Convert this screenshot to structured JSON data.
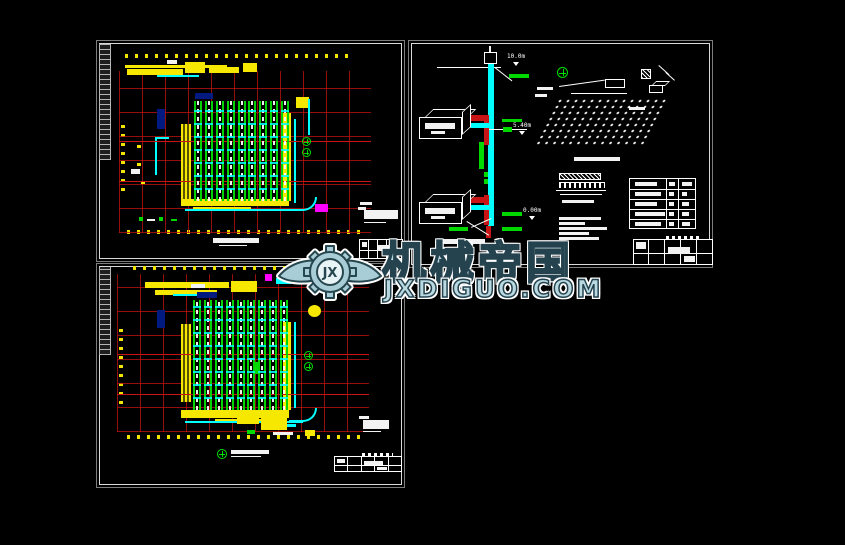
{
  "watermark": {
    "brand_cn": "机械帝国",
    "brand_en": "JXDIGUO.COM",
    "logo_monogram": "JX"
  },
  "schematic": {
    "elevation_labels": {
      "top": "10.0m",
      "mid": "5.40m",
      "ground": "0.00m"
    }
  },
  "palette": {
    "grid_red": "#c81414",
    "pipe_cyan": "#00ffff",
    "sprinkler_green": "#00d400",
    "wall_yellow": "#f6e800",
    "highlight_magenta": "#ff00ff",
    "watermark_blue": "#b9d8e0",
    "sheet_border": "#d9d9d9"
  }
}
